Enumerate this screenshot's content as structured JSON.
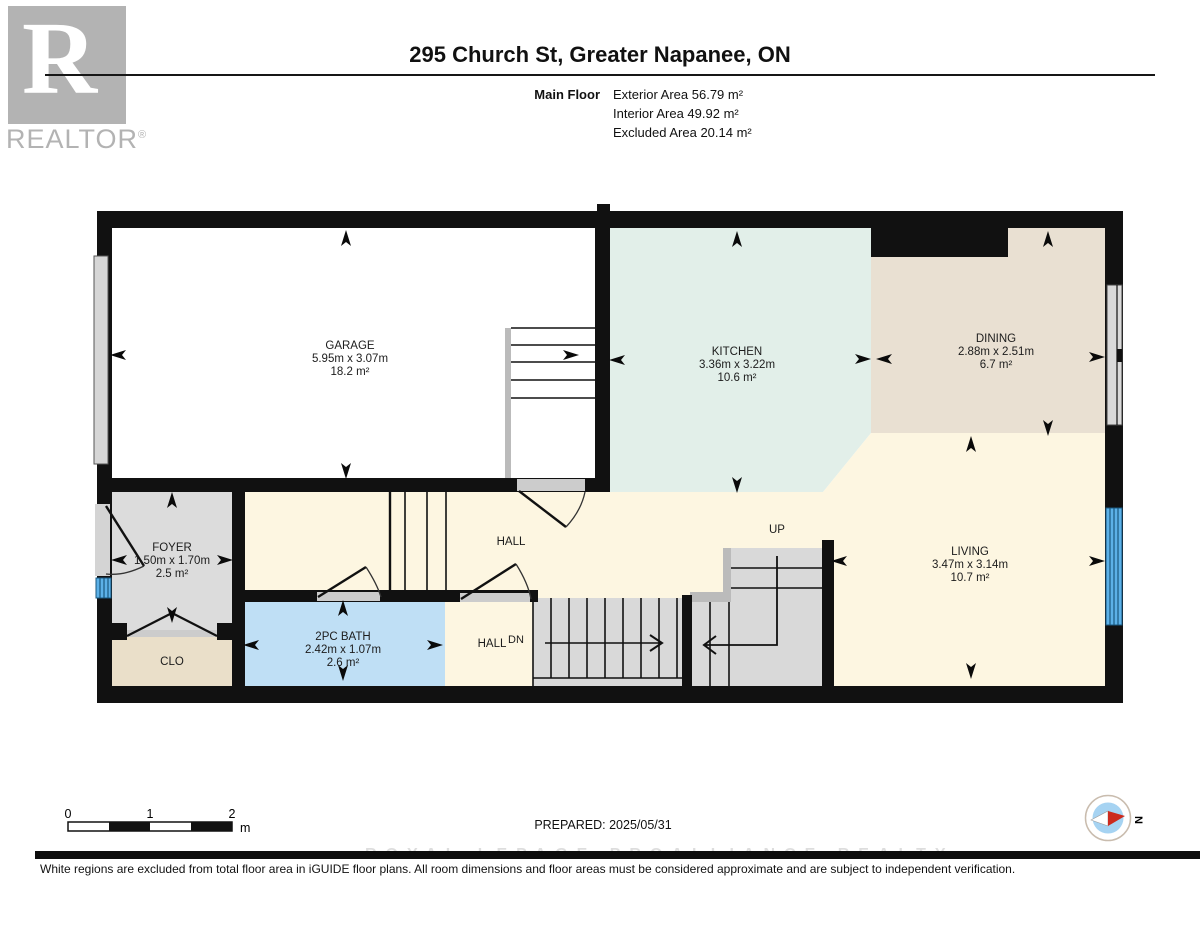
{
  "header": {
    "title": "295 Church St, Greater Napanee, ON",
    "floor_label": "Main Floor",
    "areas": [
      "Exterior Area 56.79 m²",
      "Interior Area 49.92 m²",
      "Excluded Area 20.14 m²"
    ]
  },
  "logo": {
    "letter": "R",
    "brand": "REALTOR",
    "registered": "®"
  },
  "rooms": {
    "garage": {
      "name": "GARAGE",
      "dims": "5.95m x 3.07m",
      "area": "18.2 m²"
    },
    "kitchen": {
      "name": "KITCHEN",
      "dims": "3.36m x 3.22m",
      "area": "10.6 m²"
    },
    "dining": {
      "name": "DINING",
      "dims": "2.88m x 2.51m",
      "area": "6.7 m²"
    },
    "living": {
      "name": "LIVING",
      "dims": "3.47m x 3.14m",
      "area": "10.7 m²"
    },
    "foyer": {
      "name": "FOYER",
      "dims": "1.50m x 1.70m",
      "area": "2.5 m²"
    },
    "bath": {
      "name": "2PC BATH",
      "dims": "2.42m x 1.07m",
      "area": "2.6 m²"
    },
    "closet": {
      "name": "CLO"
    },
    "hall_upper": {
      "name": "HALL"
    },
    "hall_lower": {
      "name": "HALL"
    },
    "stairs": {
      "up": "UP",
      "down": "DN"
    }
  },
  "footer": {
    "scale_ticks": [
      "0",
      "1",
      "2"
    ],
    "scale_unit": "m",
    "prepared": "PREPARED: 2025/05/31",
    "compass": "N"
  },
  "watermark": "ROYAL LEPAGE PROALLIANCE REALTY",
  "disclaimer": "White regions are excluded from total floor area in iGUIDE floor plans. All room dimensions and floor areas must be considered approximate and are subject to independent verification.",
  "colors": {
    "wall": "#111111",
    "garage": "#ffffff",
    "kitchen": "#e2efe9",
    "dining": "#e9e0d2",
    "hall_living": "#fdf6e1",
    "foyer": "#dcdcdc",
    "closet": "#eadfc9",
    "bath": "#bfdff5",
    "stairs": "#d9d9d9",
    "window_blue": "#5cb1e8",
    "compass_red": "#cc2a1e"
  }
}
